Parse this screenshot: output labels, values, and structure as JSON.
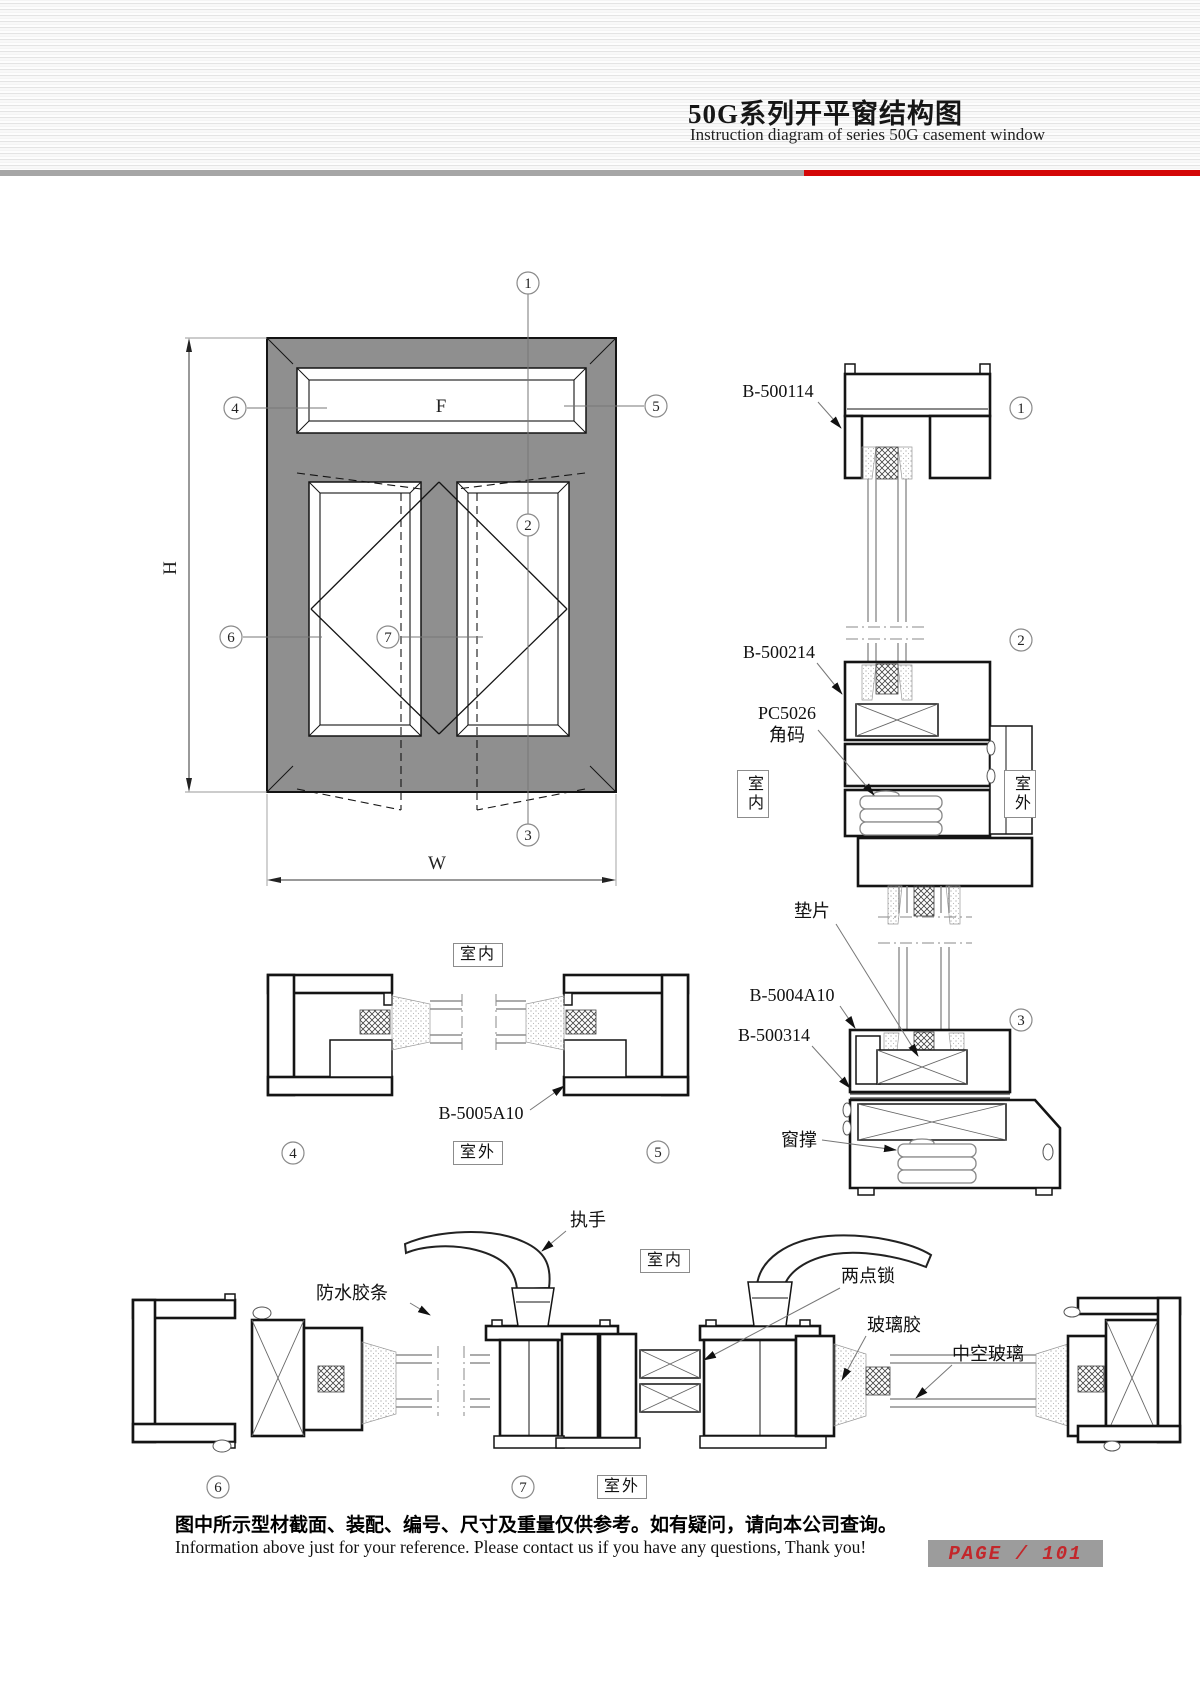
{
  "header": {
    "title": "50G系列开平窗结构图",
    "subtitle": "Instruction diagram of series 50G casement window"
  },
  "elevation": {
    "fixed_label": "F",
    "dim_h": "H",
    "dim_w": "W"
  },
  "nums": {
    "n1": "1",
    "n2": "2",
    "n3": "3",
    "n4": "4",
    "n5": "5",
    "n6": "6",
    "n7": "7"
  },
  "labels": {
    "b500114": "B-500114",
    "b500214": "B-500214",
    "pc5026": "PC5026",
    "jiaoma": "角码",
    "dianpian": "垫片",
    "b5004a10": "B-5004A10",
    "b500314": "B-500314",
    "chuangcheng": "窗撑",
    "b5005a10": "B-5005A10",
    "zhishou": "执手",
    "fangshui": "防水胶条",
    "liangdiansuo": "两点锁",
    "bolijiao": "玻璃胶",
    "zhongkongboli": "中空玻璃",
    "indoor": "室内",
    "outdoor": "室外"
  },
  "footer": {
    "note_zh": "图中所示型材截面、装配、编号、尺寸及重量仅供参考。如有疑问，请向本公司查询。",
    "note_en": "Information above just for your reference. Please contact us if you have any questions, Thank you!",
    "page": "PAGE / 101"
  }
}
